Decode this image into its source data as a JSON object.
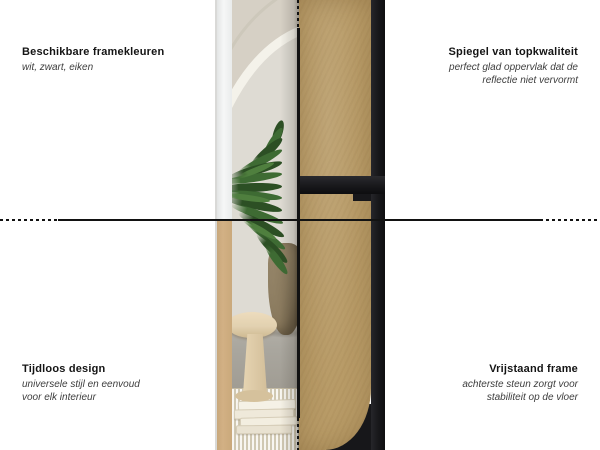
{
  "annotations": {
    "top_left": {
      "title": "Beschikbare framekleuren",
      "subtitle_lines": [
        "wit, zwart, eiken"
      ]
    },
    "top_right": {
      "title": "Spiegel van topkwaliteit",
      "subtitle_lines": [
        "perfect glad oppervlak dat de",
        "reflectie niet vervormt"
      ]
    },
    "bottom_left": {
      "title": "Tijdloos design",
      "subtitle_lines": [
        "universele stijl en eenvoud",
        "voor elk interieur"
      ]
    },
    "bottom_right": {
      "title": "Vrijstaand frame",
      "subtitle_lines": [
        "achterste steun zorgt voor",
        "stabiliteit op de vloer"
      ]
    }
  },
  "colors": {
    "background": "#ffffff",
    "line": "#121212",
    "heading_text": "#141414",
    "subtext": "#3d3d3d",
    "mdf_panel": "#b89b67",
    "frame_black": "#17171a",
    "frame_white": "#f1f2f2",
    "frame_oak": "#d2b084",
    "wall": "#dedbd3",
    "wall_shade": "#d6d0c5",
    "arc_highlight": "#f4f2ea",
    "floor": "#aaa79f",
    "rug": "#e3dcc8",
    "plant_dark": "#2c4f24",
    "plant_mid": "#3e6b33",
    "plant_light": "#4f7f3e",
    "pot": "#8a7a5e",
    "stool": "#e2d1b0"
  }
}
